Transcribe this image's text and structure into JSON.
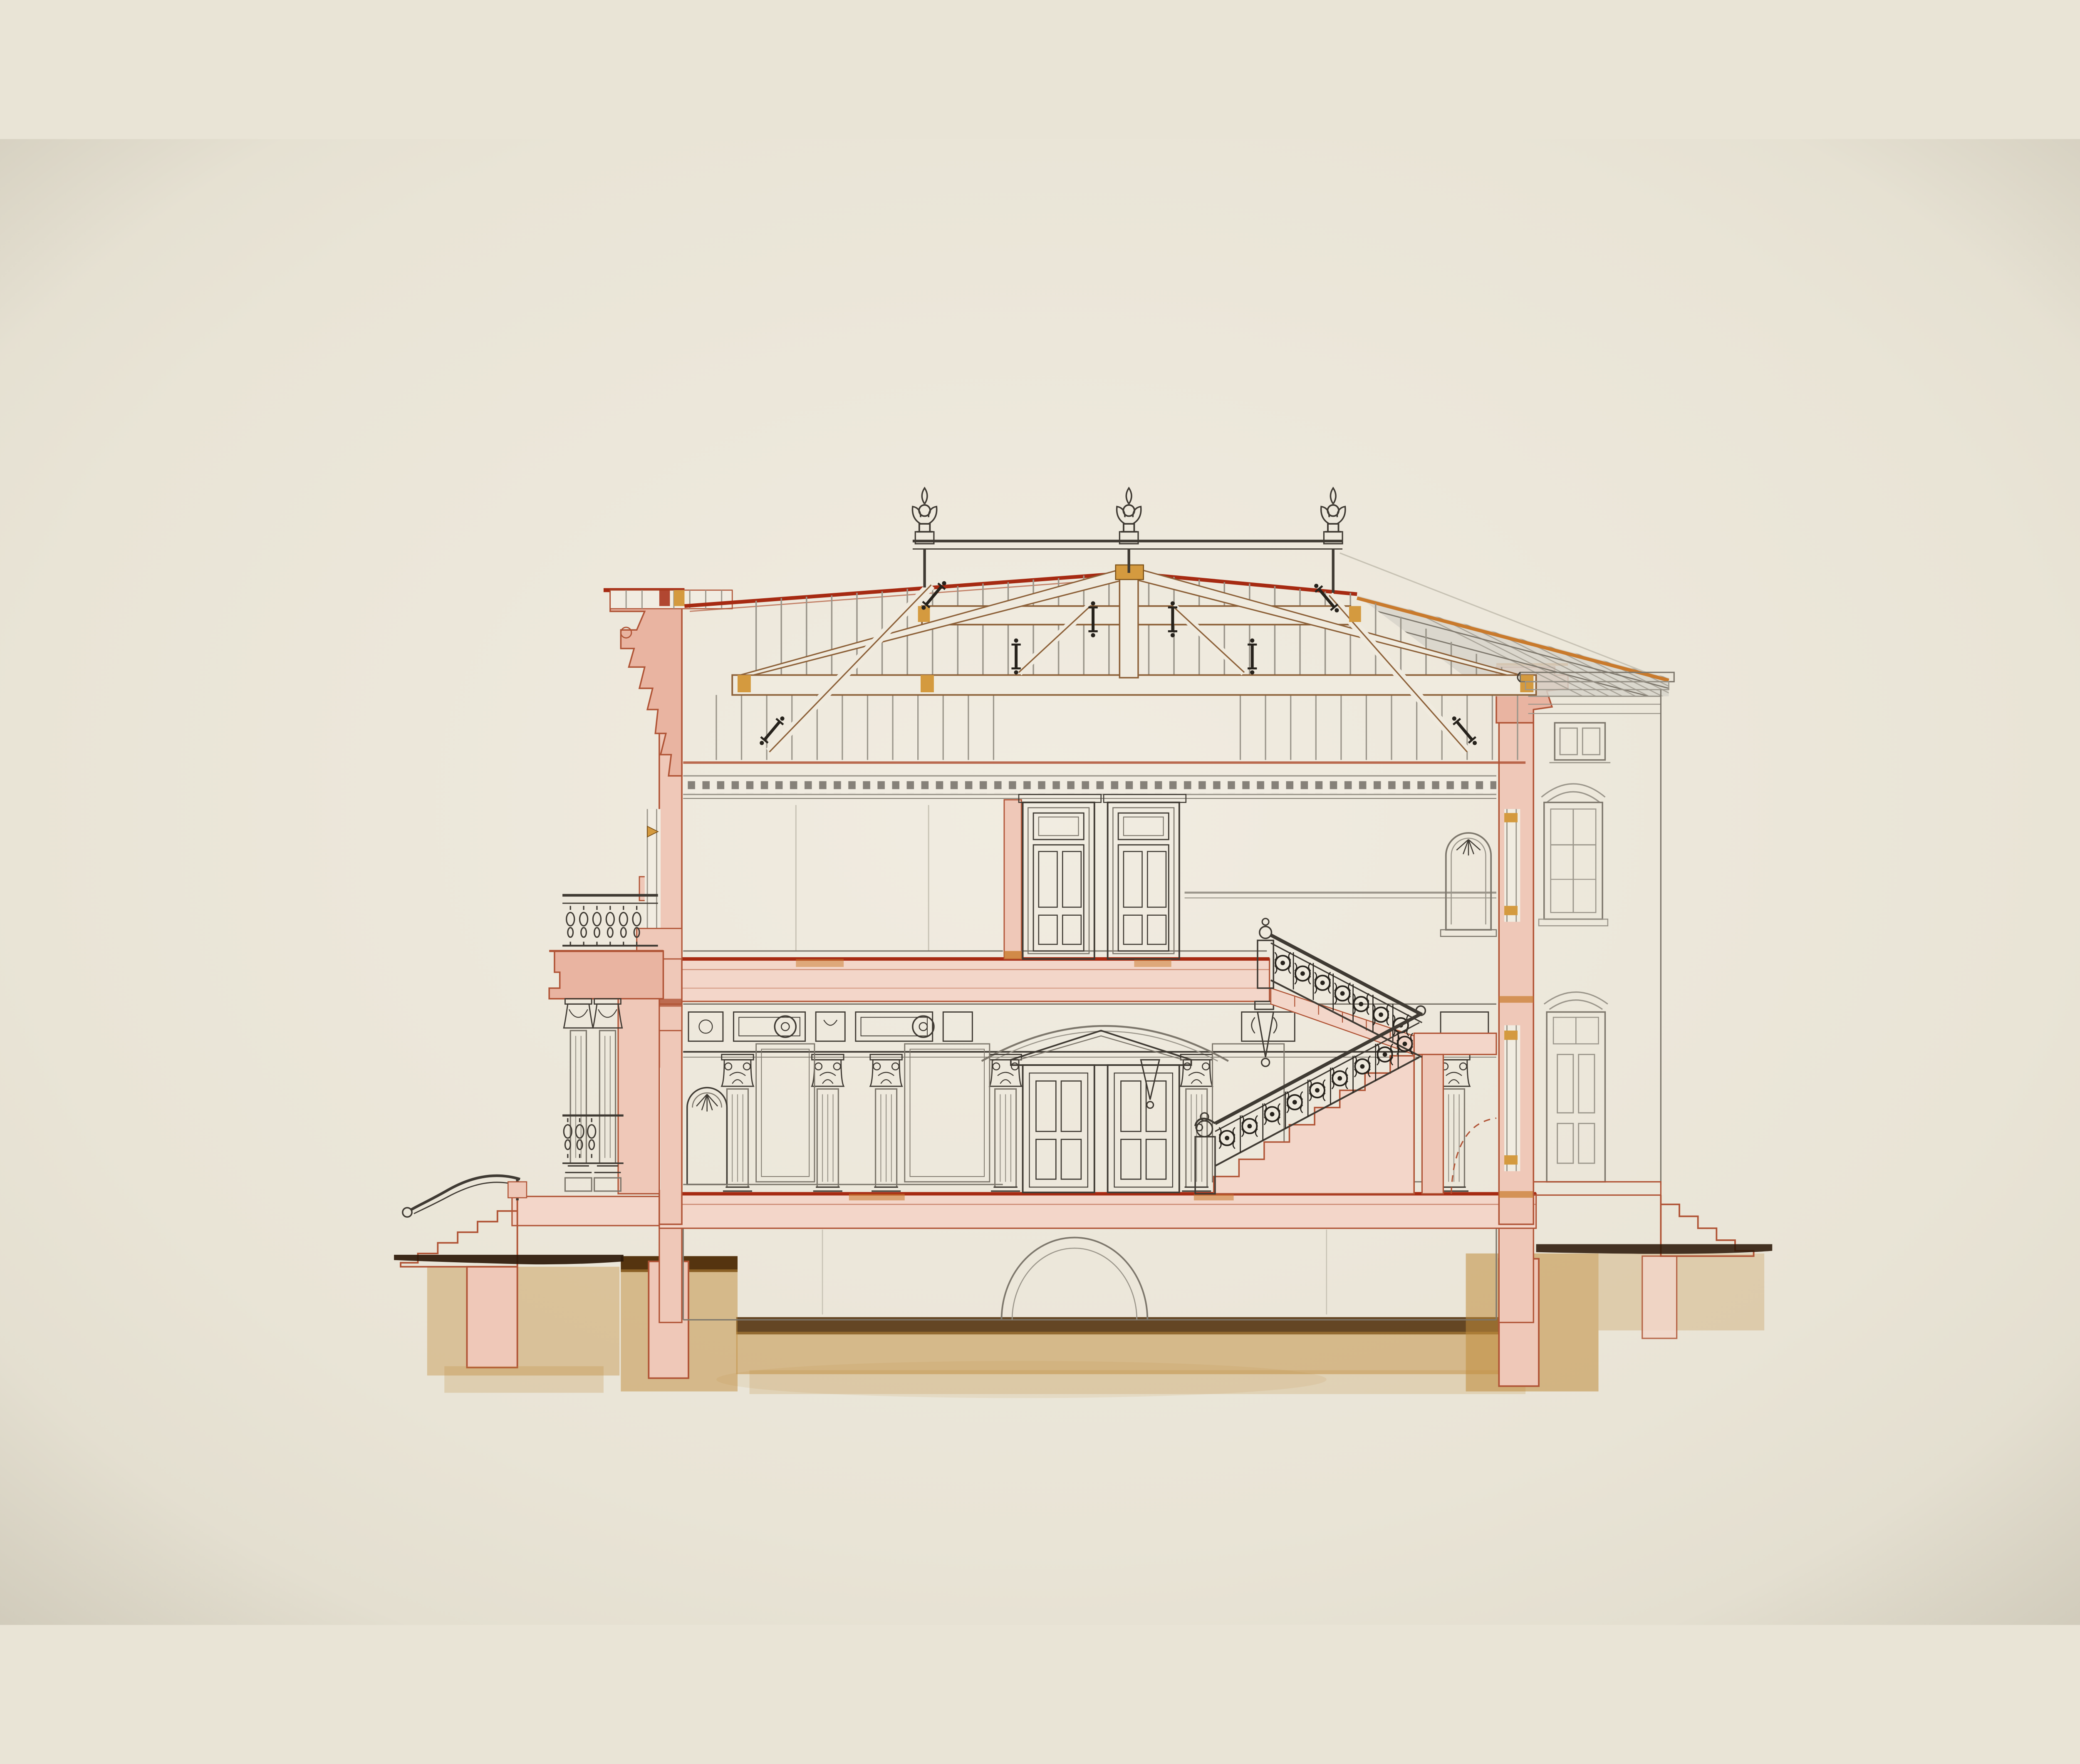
{
  "artwork": {
    "kind": "architectural-cross-section-drawing",
    "subject": "two-story villa section with roof truss, grand staircase and foundations",
    "technique": "ink line work with pink masonry wash and amber foundation wash on cream paper",
    "finial_count": 3,
    "storeys": 2,
    "stair_flights": 2,
    "visible_text": ""
  },
  "colors": {
    "paper": "#e9e4d6",
    "paper_edge": "#ddd8c8",
    "paper_light": "#f1ece1",
    "ink": "#3f3a33",
    "ink_light": "#7d776c",
    "gray_line": "#9b968b",
    "guide": "#c7c2b4",
    "red_bright": "#a62a12",
    "red_brown": "#b05436",
    "orange": "#c97a2c",
    "pink": "#efc8b8",
    "pink_deep": "#e9b4a1",
    "pink_slab": "#f3d6c9",
    "ochre": "#d49a3f",
    "amber": "#c08c3c",
    "amber_deep": "#7d5218",
    "umber": "#55340f",
    "ground_dark": "#2b1808",
    "roof_gray": "#d7d4ca",
    "beam_fill": "#f0ebdf",
    "beam_stroke": "#8c6038",
    "tint": "#dcd8cd",
    "iron": "#26221c"
  }
}
